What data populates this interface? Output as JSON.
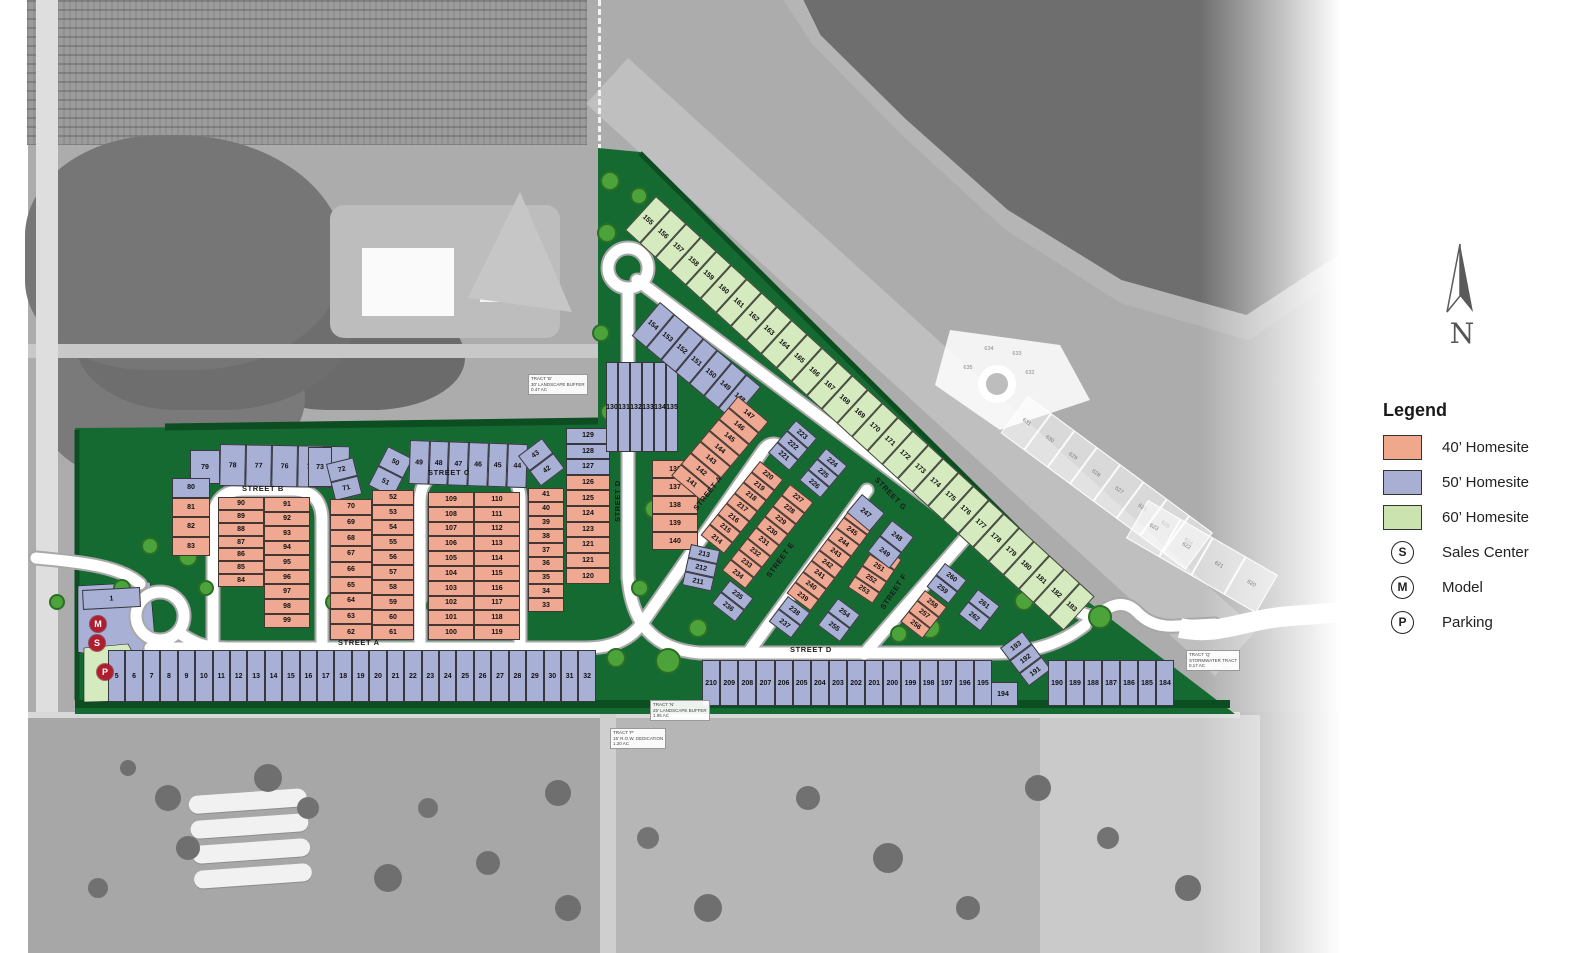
{
  "north_label": "N",
  "legend": {
    "title": "Legend",
    "items": [
      {
        "type": "swatch",
        "color": "#F0A88D",
        "label": "40’ Homesite"
      },
      {
        "type": "swatch",
        "color": "#A9AFD3",
        "label": "50’ Homesite"
      },
      {
        "type": "swatch",
        "color": "#CBE4AF",
        "label": "60’ Homesite"
      },
      {
        "type": "symbol",
        "symbol": "S",
        "label": "Sales Center"
      },
      {
        "type": "symbol",
        "symbol": "M",
        "label": "Model"
      },
      {
        "type": "symbol",
        "symbol": "P",
        "label": "Parking"
      }
    ]
  },
  "map": {
    "colors": {
      "homesite40": "#EFA992",
      "homesite50": "#A9B0D5",
      "homesite60": "#D6EABF",
      "site_green": "#156A31",
      "road": "#FFFFFF",
      "marker_red": "#AF1E2D"
    },
    "street_labels": [
      {
        "text": "STREET A"
      },
      {
        "text": "STREET B"
      },
      {
        "text": "STREET C"
      },
      {
        "text": "STREET D"
      },
      {
        "text": "STREET A"
      },
      {
        "text": "STREET D"
      },
      {
        "text": "STREET E"
      },
      {
        "text": "STREET F"
      },
      {
        "text": "STREET G"
      }
    ],
    "tracts": [
      {
        "lines": [
          "TRACT 'B'",
          "30' LANDSCAPE BUFFER",
          "0.47 AC"
        ]
      },
      {
        "lines": [
          "TRACT 'N'",
          "25' LANDSCAPE BUFFER",
          "1.95 AC"
        ]
      },
      {
        "lines": [
          "TRACT 'P'",
          "15' R.O.W. DEDICATION",
          "1.20 AC"
        ]
      },
      {
        "lines": [
          "TRACT 'Q'",
          "STORMWATER TRACT",
          "0.17 AC"
        ]
      }
    ],
    "markers": [
      {
        "symbol": "M"
      },
      {
        "symbol": "S"
      },
      {
        "symbol": "P"
      }
    ],
    "blocks": {
      "lot1": {
        "c": "50",
        "n": [
          "1"
        ]
      },
      "rowA": {
        "c": "50",
        "n": [
          "5",
          "6",
          "7",
          "8",
          "9",
          "10",
          "11",
          "12",
          "13",
          "14",
          "15",
          "16",
          "17",
          "18",
          "19",
          "20",
          "21",
          "22",
          "23",
          "24",
          "25",
          "26",
          "27",
          "28",
          "29",
          "30",
          "31",
          "32"
        ]
      },
      "lot79": {
        "c": "50",
        "n": [
          "79"
        ]
      },
      "row78": {
        "c": "50",
        "n": [
          "78",
          "77",
          "76",
          "75",
          "74"
        ]
      },
      "lot73": {
        "c": "50",
        "n": [
          "73"
        ]
      },
      "col72": {
        "c": "50",
        "n": [
          "72",
          "71"
        ]
      },
      "col50": {
        "c": "50",
        "n": [
          "50",
          "51"
        ]
      },
      "row49": {
        "c": "50",
        "n": [
          "49",
          "48",
          "47",
          "46",
          "45",
          "44"
        ]
      },
      "col43": {
        "c": "50",
        "n": [
          "43",
          "42"
        ]
      },
      "leftEdge": {
        "lots": [
          [
            "80",
            "50"
          ],
          [
            "81",
            "40"
          ],
          [
            "82",
            "40"
          ],
          [
            "83",
            "40"
          ]
        ]
      },
      "bL": {
        "c": "40",
        "n": [
          "90",
          "89",
          "88",
          "87",
          "86",
          "85",
          "84"
        ]
      },
      "bR": {
        "c": "40",
        "n": [
          "91",
          "92",
          "93",
          "94",
          "95",
          "96",
          "97",
          "98",
          "99"
        ]
      },
      "c70": {
        "c": "40",
        "n": [
          "70",
          "69",
          "68",
          "67",
          "66",
          "65",
          "64",
          "63",
          "62"
        ]
      },
      "c52": {
        "c": "40",
        "n": [
          "52",
          "53",
          "54",
          "55",
          "56",
          "57",
          "58",
          "59",
          "60",
          "61"
        ]
      },
      "cL": {
        "c": "40",
        "n": [
          "109",
          "108",
          "107",
          "106",
          "105",
          "104",
          "103",
          "102",
          "101",
          "100"
        ]
      },
      "cR": {
        "c": "40",
        "n": [
          "110",
          "111",
          "112",
          "113",
          "114",
          "115",
          "116",
          "117",
          "118",
          "119"
        ]
      },
      "c41": {
        "c": "40",
        "n": [
          "41",
          "40",
          "39",
          "38",
          "37",
          "36",
          "35",
          "34",
          "33"
        ]
      },
      "c129": {
        "lots": [
          [
            "129",
            "50"
          ],
          [
            "128",
            "50"
          ],
          [
            "127",
            "50"
          ],
          [
            "126",
            "40"
          ],
          [
            "125",
            "40"
          ],
          [
            "124",
            "40"
          ],
          [
            "123",
            "40"
          ],
          [
            "121",
            "40"
          ],
          [
            "121",
            "40"
          ],
          [
            "120",
            "40"
          ]
        ]
      },
      "cl130": {
        "c": "50",
        "n": [
          "130",
          "131",
          "132",
          "133",
          "134",
          "135"
        ]
      },
      "c136": {
        "c": "40",
        "n": [
          "136",
          "137",
          "138",
          "139",
          "140"
        ]
      },
      "d148": {
        "c": "50",
        "n": [
          "154",
          "153",
          "152",
          "151",
          "150",
          "149",
          "148"
        ]
      },
      "d141": {
        "c": "40",
        "n": [
          "147",
          "146",
          "145",
          "144",
          "143",
          "142",
          "141"
        ]
      },
      "green": {
        "c": "60",
        "n": [
          "155",
          "156",
          "157",
          "158",
          "159",
          "160",
          "161",
          "162",
          "163",
          "164",
          "165",
          "166",
          "167",
          "168",
          "169",
          "170",
          "171",
          "172",
          "173",
          "174",
          "175",
          "176",
          "177",
          "178",
          "179",
          "180",
          "181",
          "182",
          "183"
        ]
      },
      "arc1": {
        "c": "50",
        "n": [
          "223",
          "222",
          "221"
        ]
      },
      "arc2": {
        "c": "50",
        "n": [
          "224",
          "225",
          "226"
        ]
      },
      "pA": {
        "c": "40",
        "n": [
          "220",
          "219",
          "218",
          "217",
          "216",
          "215",
          "214"
        ]
      },
      "pB": {
        "c": "40",
        "n": [
          "227",
          "228",
          "229",
          "230",
          "231",
          "232",
          "233",
          "234"
        ]
      },
      "s235": {
        "c": "50",
        "n": [
          "235",
          "236"
        ]
      },
      "w211": {
        "c": "50",
        "n": [
          "213",
          "212",
          "211"
        ]
      },
      "eA": {
        "c": "40",
        "n": [
          "246",
          "245",
          "244",
          "243",
          "242",
          "241",
          "240",
          "239"
        ]
      },
      "eB": {
        "c": "40",
        "n": [
          "250",
          "251",
          "252",
          "253"
        ]
      },
      "e247": {
        "c": "50",
        "n": [
          "247"
        ]
      },
      "e248": {
        "c": "50",
        "n": [
          "248",
          "249"
        ]
      },
      "e238": {
        "c": "50",
        "n": [
          "238",
          "237"
        ]
      },
      "e254": {
        "c": "50",
        "n": [
          "254",
          "255"
        ]
      },
      "f258": {
        "c": "40",
        "n": [
          "258",
          "257",
          "256"
        ]
      },
      "f260": {
        "c": "50",
        "n": [
          "260",
          "259"
        ]
      },
      "f261": {
        "c": "50",
        "n": [
          "261",
          "262"
        ]
      },
      "brDiag": {
        "c": "50",
        "n": [
          "193",
          "192",
          "191"
        ]
      },
      "lot194": {
        "c": "50",
        "n": [
          "194"
        ]
      },
      "brRow": {
        "c": "50",
        "n": [
          "190",
          "189",
          "188",
          "187",
          "186",
          "185",
          "184"
        ]
      },
      "rowD": {
        "c": "50",
        "n": [
          "210",
          "209",
          "208",
          "207",
          "206",
          "205",
          "204",
          "203",
          "202",
          "201",
          "200",
          "199",
          "198",
          "197",
          "196",
          "195"
        ]
      },
      "fs1": {
        "c": "future",
        "n": [
          "631",
          "630",
          "629",
          "628",
          "627",
          "626",
          "625",
          "624"
        ]
      },
      "fs2": {
        "c": "future",
        "n": [
          "623",
          "622",
          "621",
          "620"
        ]
      }
    },
    "future_fan": [
      {
        "n": "635",
        "x": 968,
        "y": 368
      },
      {
        "n": "634",
        "x": 989,
        "y": 349
      },
      {
        "n": "633",
        "x": 1017,
        "y": 354
      },
      {
        "n": "632",
        "x": 1030,
        "y": 373
      }
    ]
  }
}
